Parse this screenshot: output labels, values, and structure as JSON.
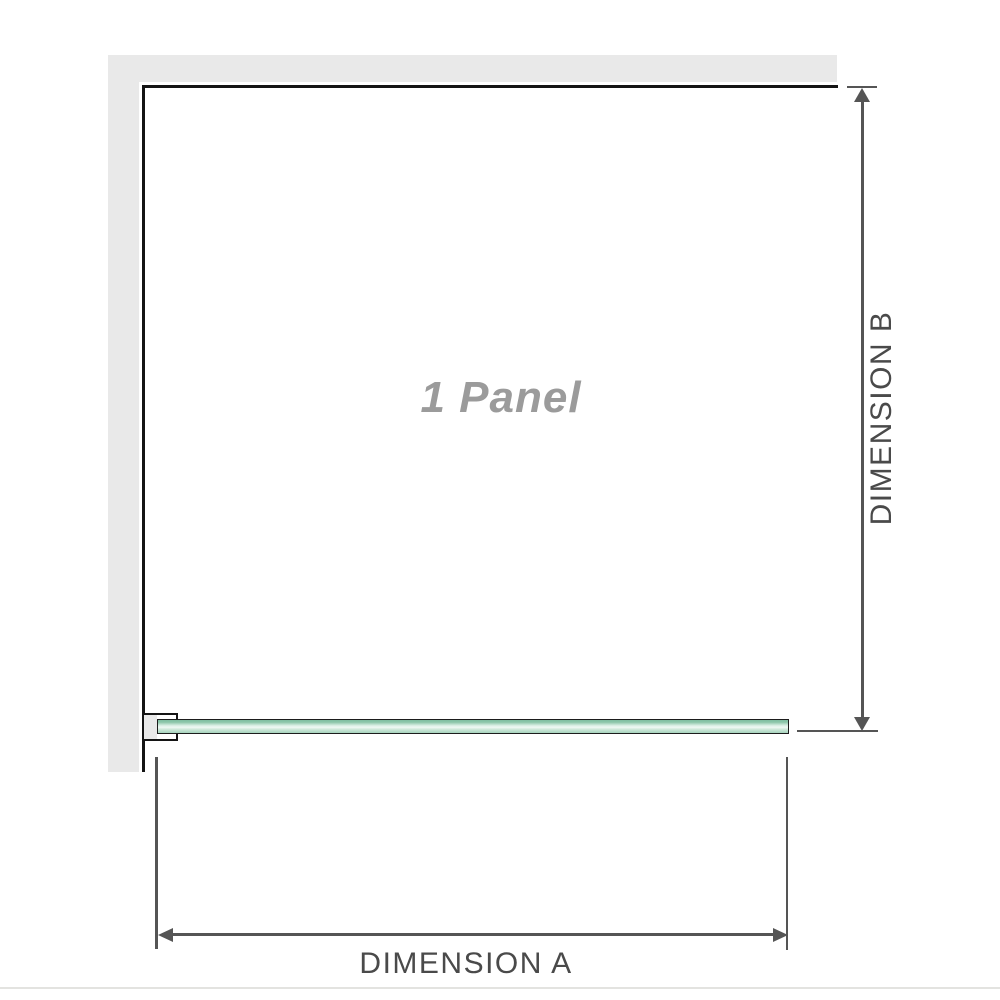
{
  "diagram": {
    "panel_label": "1 Panel",
    "dimension_a": {
      "label": "DIMENSION A",
      "orientation": "horizontal"
    },
    "dimension_b": {
      "label": "DIMENSION B",
      "orientation": "vertical"
    },
    "parts": {
      "wall": "l-shaped-wall",
      "bracket": "wall-channel-bracket",
      "glass": "glass-panel-plan-view"
    }
  },
  "colors": {
    "wall": "#e9e9e9",
    "outline": "#141414",
    "dim": "#555555",
    "dim-text": "#4a4a4a",
    "panel-text": "#9b9b9b",
    "glass-top": "#7fbda0",
    "glass-light": "#f0f9f4",
    "glass-bottom": "#a6d4bd",
    "divider": "#e3e3e0"
  }
}
